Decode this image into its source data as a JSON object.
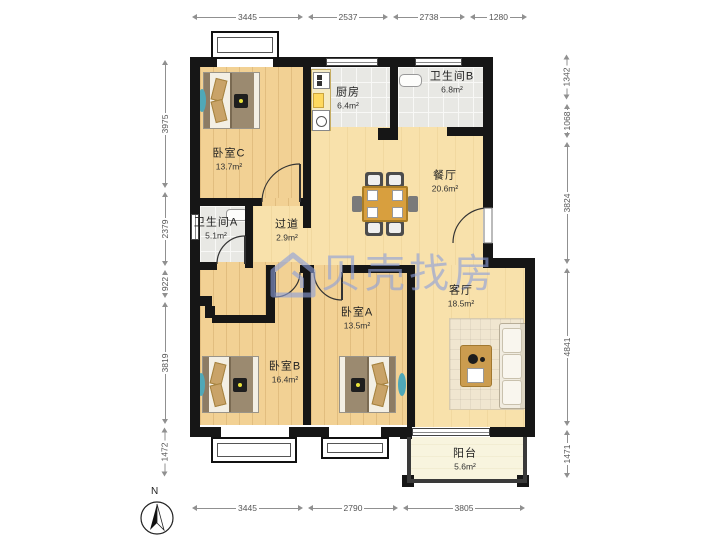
{
  "watermark": {
    "text": "贝壳找房"
  },
  "compass": {
    "label": "N"
  },
  "dims": {
    "top": [
      "3445",
      "2537",
      "2738",
      "1280"
    ],
    "bottom": [
      "3445",
      "2790",
      "3805"
    ],
    "left": [
      "3975",
      "2379",
      "922",
      "3819",
      "1472"
    ],
    "right": [
      "1342",
      "1068",
      "3824",
      "4841",
      "1471"
    ]
  },
  "rooms": {
    "bedroom_c": {
      "name": "卧室C",
      "area": "13.7m²"
    },
    "kitchen": {
      "name": "厨房",
      "area": "6.4m²"
    },
    "bathroom_b": {
      "name": "卫生间B",
      "area": "6.8m²"
    },
    "dining": {
      "name": "餐厅",
      "area": "20.6m²"
    },
    "bathroom_a": {
      "name": "卫生间A",
      "area": "5.1m²"
    },
    "corridor": {
      "name": "过道",
      "area": "2.9m²"
    },
    "bedroom_b": {
      "name": "卧室B",
      "area": "16.4m²"
    },
    "bedroom_a": {
      "name": "卧室A",
      "area": "13.5m²"
    },
    "living": {
      "name": "客厅",
      "area": "18.5m²"
    },
    "balcony": {
      "name": "阳台",
      "area": "5.6m²"
    }
  }
}
